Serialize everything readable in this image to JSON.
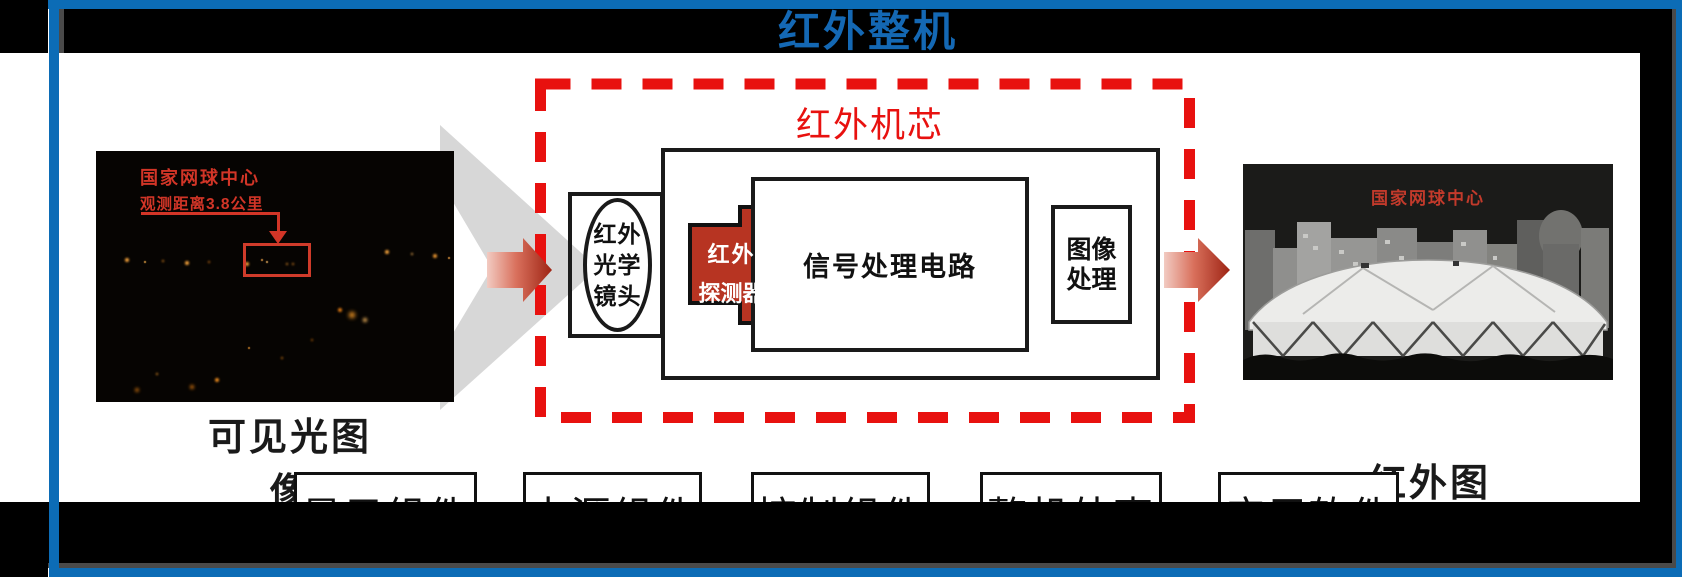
{
  "slide": {
    "title": "红外整机",
    "core_module": {
      "label": "红外机芯",
      "lens_lines": [
        "红外",
        "光学",
        "镜头"
      ],
      "detector_lines": [
        "红外",
        "探测器"
      ],
      "signal_box": "信号处理电路",
      "image_processing_lines": [
        "图像",
        "处理"
      ]
    },
    "visible_light": {
      "annotation_title": "国家网球中心",
      "annotation_distance": "观测距离3.8公里",
      "caption": "可见光图像"
    },
    "infrared": {
      "annotation_title": "国家网球中心",
      "caption": "红外图像"
    },
    "components": [
      "显示组件",
      "电源组件",
      "控制组件",
      "整机外壳",
      "应用软件"
    ],
    "colors": {
      "frame_blue": "#0c6cb6",
      "title_blue": "#1468b4",
      "accent_red": "#e8110f",
      "detector_red": "#b73422",
      "annotation_red": "#d23527",
      "chevron_gray": "#d7d7d7"
    }
  }
}
